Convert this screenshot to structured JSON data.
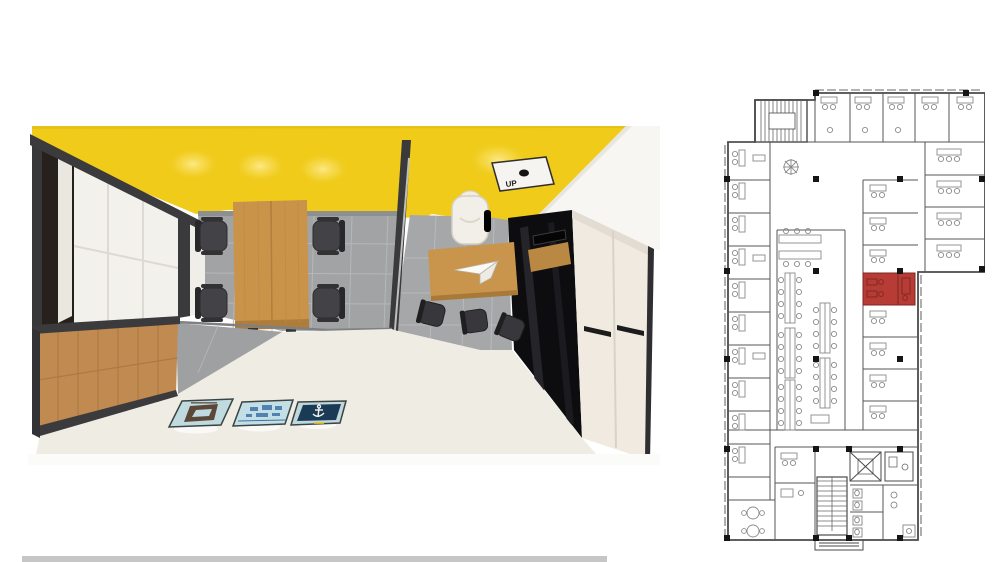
{
  "figure": {
    "left_render": {
      "type": "3d-top-down-office-render",
      "description": "Cutaway bird's-eye render of a meeting room with wooden conference table and four black chairs, and an adjacent private office with desk, white executive chair and media wall",
      "up_label": "UP",
      "colors": {
        "ceiling_yellow": "#F0CB1A",
        "table_wood": "#C9934A",
        "credenza_wood": "#C08A50",
        "floor_tile_gray": "#A2A3A5",
        "ground_cream": "#EFECE4",
        "frame_dark": "#3A3A3C",
        "media_wall_black": "#0D0D0F",
        "wardrobe_cream": "#F0EAE1",
        "poster_teal": "#BFDBDF",
        "poster_navy": "#1B3A55"
      }
    },
    "right_plan": {
      "type": "architectural-floor-plan",
      "description": "Office floor plan with perimeter offices, open benching area, core with stairs, elevator and restrooms; one room highlighted in red",
      "highlight_color": "#B63C35",
      "wall_color": "#4A4A4A",
      "column_color": "#151515"
    },
    "divider_strip_color": "#C6C6C6"
  }
}
